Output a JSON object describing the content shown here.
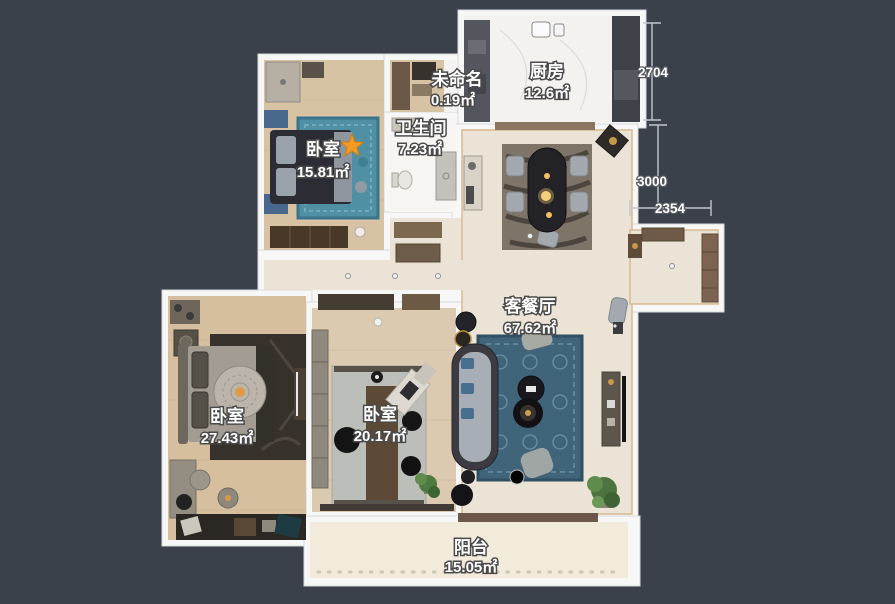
{
  "canvas": {
    "background_color": "#3a414b",
    "wall_color": "#f7f7f7",
    "accent_star_color": "#f59a23"
  },
  "rooms": [
    {
      "id": "bedroom-top-left",
      "name": "卧室",
      "area": "15.81㎡"
    },
    {
      "id": "bathroom",
      "name": "卫生间",
      "area": "7.23㎡"
    },
    {
      "id": "unnamed",
      "name": "未命名",
      "area": "0.19㎡"
    },
    {
      "id": "kitchen",
      "name": "厨房",
      "area": "12.6㎡"
    },
    {
      "id": "living-dining",
      "name": "客餐厅",
      "area": "67.62㎡"
    },
    {
      "id": "bedroom-left",
      "name": "卧室",
      "area": "27.43㎡"
    },
    {
      "id": "bedroom-middle",
      "name": "卧室",
      "area": "20.17㎡"
    },
    {
      "id": "balcony",
      "name": "阳台",
      "area": "15.05㎡"
    }
  ],
  "dimensions": [
    {
      "label": "2704",
      "orientation": "vertical"
    },
    {
      "label": "3000",
      "orientation": "vertical"
    },
    {
      "label": "2354",
      "orientation": "horizontal"
    }
  ],
  "floor_colors": {
    "wood": "#d7c2a3",
    "tile_living": "#eae3d6",
    "bath_white": "#f6f5f1",
    "kitchen_marble": "#f3f2ee",
    "balcony_cream": "#f2ebdc"
  }
}
